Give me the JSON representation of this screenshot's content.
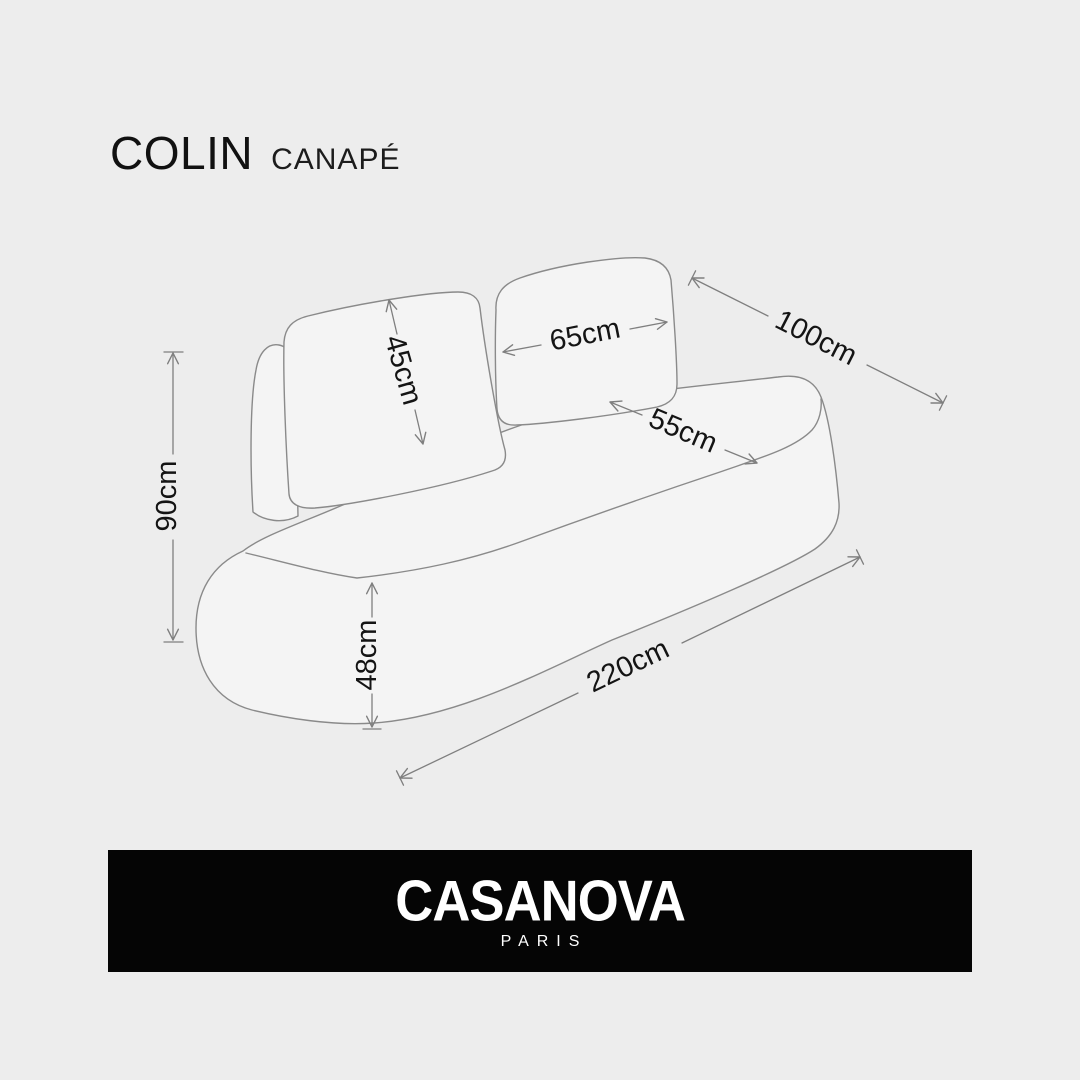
{
  "header": {
    "title": "COLIN",
    "subtitle": "CANAPÉ"
  },
  "diagram": {
    "subject": "two-seat rounded sofa line drawing with dimension arrows",
    "dimensions": {
      "back_cushion_height": "45cm",
      "back_cushion_width": "65cm",
      "depth": "100cm",
      "seat_depth": "55cm",
      "total_height": "90cm",
      "seat_height": "48cm",
      "total_width": "220cm"
    }
  },
  "footer": {
    "brand": "CASANOVA",
    "city": "PARIS"
  },
  "colors": {
    "background": "#ededed",
    "sofa_fill": "#f4f4f4",
    "sketch_line": "#8a8a8a",
    "dimension_line": "#7f7f7f",
    "label_text": "#141414",
    "banner_background": "#050505",
    "banner_text": "#ffffff"
  }
}
